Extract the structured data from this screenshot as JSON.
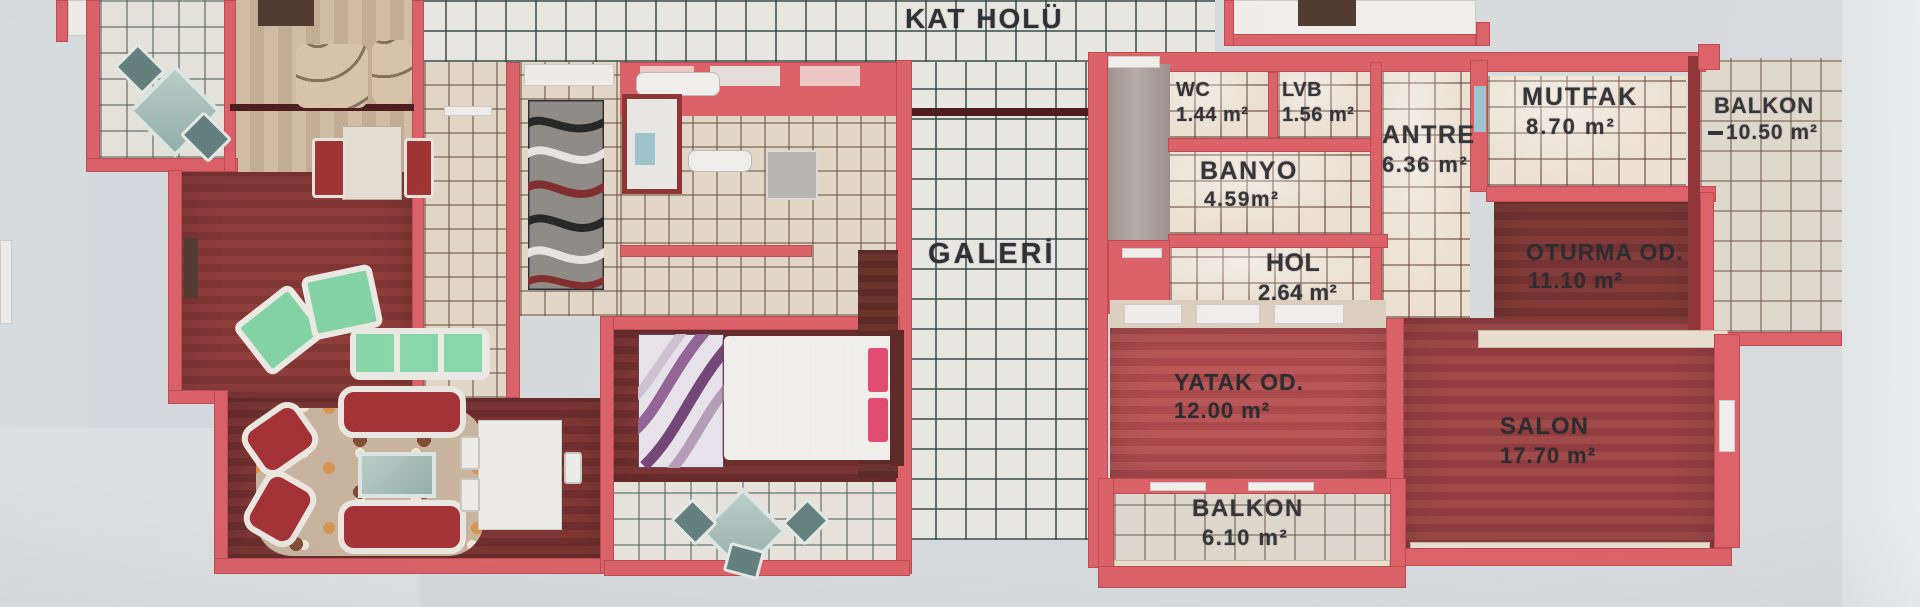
{
  "hall": {
    "label": "KAT HOLÜ"
  },
  "galeri": {
    "label": "GALERİ"
  },
  "right_apartment": {
    "rooms": {
      "wc": {
        "name": "WC",
        "area": "1.44 m²"
      },
      "lvb": {
        "name": "LVB",
        "area": "1.56 m²"
      },
      "banyo": {
        "name": "BANYO",
        "area": "4.59m²"
      },
      "antre": {
        "name": "ANTRE",
        "area": "6.36 m²"
      },
      "mutfak": {
        "name": "MUTFAK",
        "area": "8.70 m²"
      },
      "balkon_top": {
        "name": "BALKON",
        "area": "10.50 m²"
      },
      "hol": {
        "name": "HOL",
        "area": "2.64 m²"
      },
      "oturma": {
        "name": "OTURMA OD.",
        "area": "11.10 m²"
      },
      "yatak": {
        "name": "YATAK OD.",
        "area": "12.00 m²"
      },
      "salon": {
        "name": "SALON",
        "area": "17.70 m²"
      },
      "balkon_bottom": {
        "name": "BALKON",
        "area": "6.10 m²"
      }
    }
  },
  "colors": {
    "wall_red": "#dc5a62",
    "wall_dark": "#8c2b2e",
    "tile_light": "#ebdfd0",
    "wood_dark": "#6e2829",
    "wood_mid": "#8d3336",
    "wood_bright": "#a84043",
    "background": "#d6dadd",
    "label_text": "#2b2a2e"
  }
}
